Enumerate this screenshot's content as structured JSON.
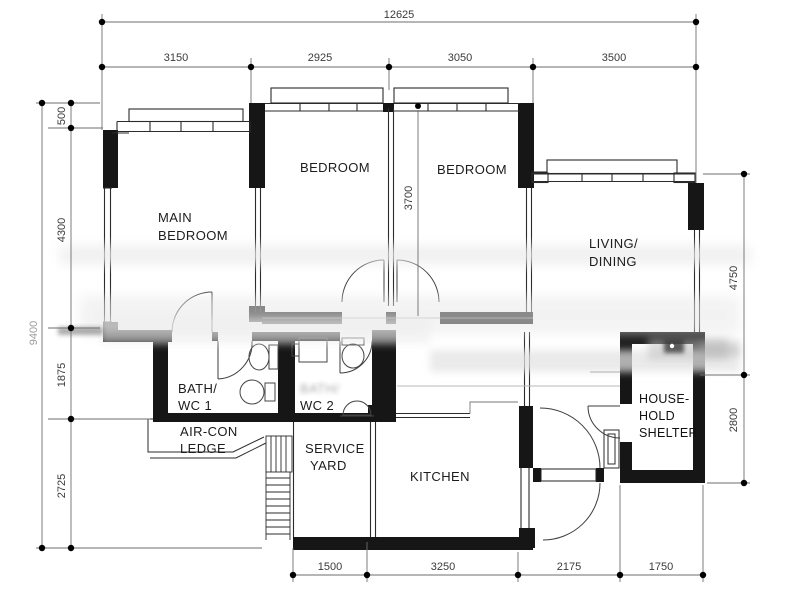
{
  "drawing": {
    "rooms": {
      "main_bedroom": {
        "line1": "MAIN",
        "line2": "BEDROOM"
      },
      "bedroom2": {
        "label": "BEDROOM"
      },
      "bedroom3": {
        "label": "BEDROOM"
      },
      "living_dining": {
        "line1": "LIVING/",
        "line2": "DINING"
      },
      "bath_wc1": {
        "line1": "BATH/",
        "line2": "WC 1"
      },
      "bath_wc2": {
        "line1": "BATH/",
        "line2": "WC 2"
      },
      "aircon_ledge": {
        "line1": "AIR-CON",
        "line2": "LEDGE"
      },
      "service_yard": {
        "line1": "SERVICE",
        "line2": "YARD"
      },
      "kitchen": {
        "label": "KITCHEN"
      },
      "household_shelter": {
        "line1": "HOUSE-",
        "line2": "HOLD",
        "line3": "SHELTER"
      }
    },
    "dimensions": {
      "top_total": "12625",
      "top_segments": [
        "3150",
        "2925",
        "3050",
        "3500"
      ],
      "left_total": "9400",
      "left_segments": [
        "500",
        "4300",
        "1875",
        "2725"
      ],
      "right_segments": [
        "4750",
        "2800"
      ],
      "bottom_segments": [
        "1500",
        "3250",
        "2175",
        "1750"
      ],
      "bedroom_depth": "3700"
    }
  }
}
